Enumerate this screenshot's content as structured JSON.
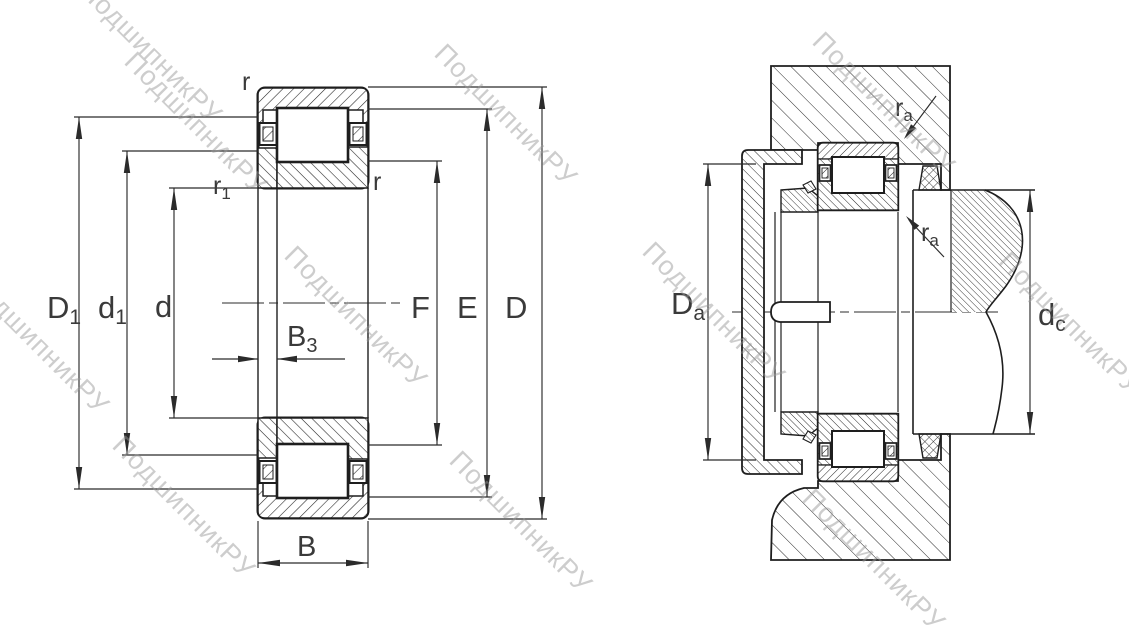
{
  "drawing": {
    "type": "bearing-technical-drawing",
    "description_visible": false
  },
  "watermark": {
    "text": "ПодшипникРУ"
  },
  "left_view": {
    "labels": {
      "D1": {
        "main": "D",
        "sub": "1"
      },
      "d1": {
        "main": "d",
        "sub": "1"
      },
      "d": {
        "main": "d"
      },
      "B3": {
        "main": "B",
        "sub": "3"
      },
      "B": {
        "main": "B"
      },
      "F": {
        "main": "F"
      },
      "E": {
        "main": "E"
      },
      "D": {
        "main": "D"
      },
      "r_top": {
        "main": "r"
      },
      "r_side": {
        "main": "r"
      },
      "r1": {
        "main": "r",
        "sub": "1"
      }
    }
  },
  "right_view": {
    "labels": {
      "Da": {
        "main": "D",
        "sub": "a"
      },
      "dc": {
        "main": "d",
        "sub": "c"
      },
      "ra_top": {
        "main": "r",
        "sub": "a"
      },
      "ra_side": {
        "main": "r",
        "sub": "a"
      }
    }
  },
  "colors": {
    "line": "#1e1e1e",
    "dimension": "#2b2b2b",
    "label": "#3a3a3a",
    "watermark": "#969696",
    "background": "#ffffff"
  }
}
